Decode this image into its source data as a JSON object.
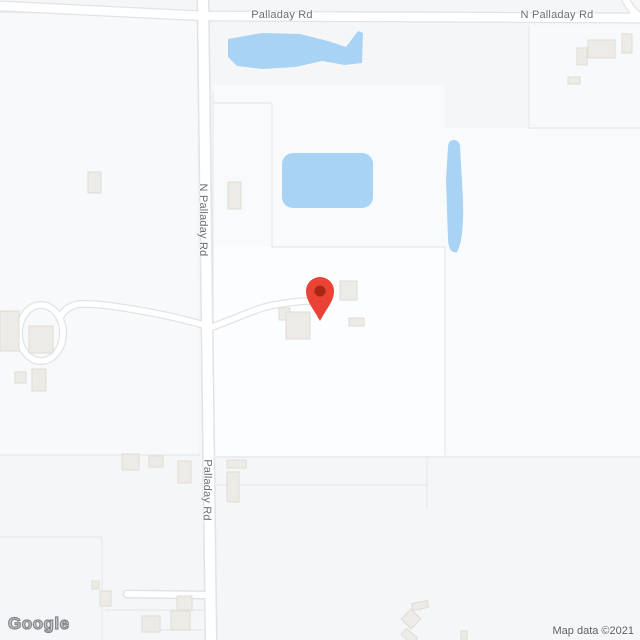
{
  "map": {
    "provider": "Google Maps",
    "watermark": "Google",
    "attribution": "Map data ©2021",
    "road_labels": {
      "top_west": "Palladay Rd",
      "top_east": "N Palladay Rd",
      "side_upper": "N Palladay Rd",
      "side_lower": "Palladay Rd"
    },
    "marker": {
      "name": "location-pin",
      "color": "#ea4335",
      "inner_color": "#a52714"
    },
    "theme": {
      "background": "#f5f6f8",
      "parcel_light": "#f8f9fb",
      "parcel_bright": "#fcfdfe",
      "parcel_mid": "#f9fafb",
      "parcel_line": "#e6e8eb",
      "road_fill": "#ffffff",
      "road_casing": "#e1e3e6",
      "water": "#a9d3f5",
      "building_fill": "#edebe6",
      "building_stroke": "#dfdcd6",
      "marker_color": "#ea4335",
      "marker_inner": "#a52714",
      "label_color": "#696d72",
      "attribution_color": "#5a5d61"
    }
  }
}
